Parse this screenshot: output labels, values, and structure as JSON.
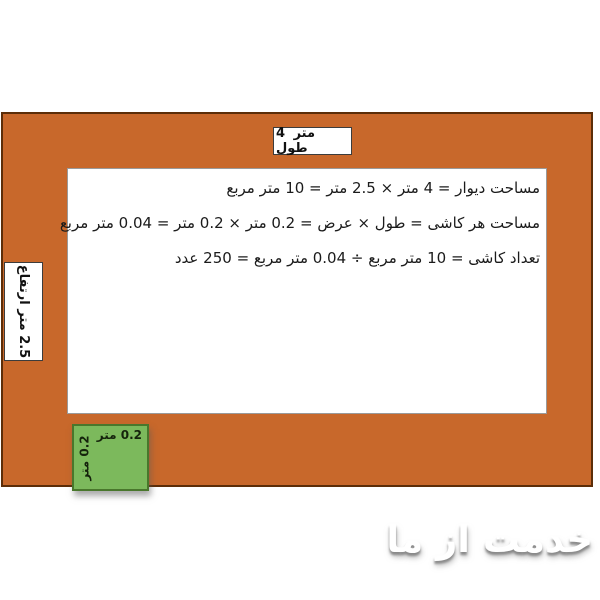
{
  "diagram": {
    "wall": {
      "length_label": "4 متر طول",
      "height_label": "2.5 متر ارتفاع"
    },
    "tile": {
      "width_label": "0.2 متر",
      "height_label": "0.2 متر"
    },
    "calculations": {
      "wall_area": "مساحت دیوار = 4 متر × 2.5 متر = 10 متر مربع",
      "tile_area": "مساحت هر کاشی = طول × عرض = 0.2 متر × 0.2 متر = 0.04 متر مربع",
      "tile_count": "تعداد کاشی = 10 متر مربع ÷ 0.04 متر مربع = 250 عدد"
    },
    "watermark": "خدمت از ما",
    "colors": {
      "wall_fill": "#c8682b",
      "wall_border": "#5c2d08",
      "tile_fill": "#7cb95c",
      "tile_border": "#49772c"
    }
  }
}
